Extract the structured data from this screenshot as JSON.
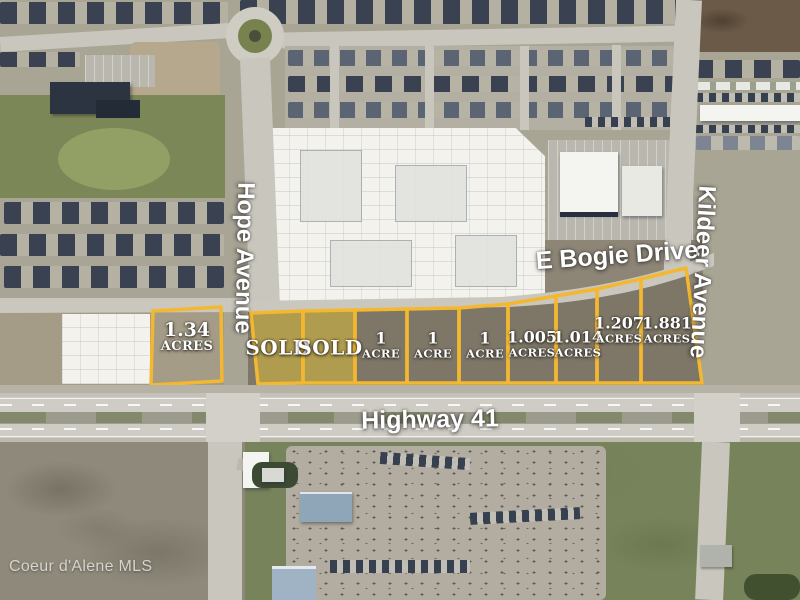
{
  "watermark": "Coeur d'Alene MLS",
  "roads": {
    "hope": "Hope Avenue",
    "bogie": "E Bogie Drive",
    "kildeer": "Kildeer Avenue",
    "highway": "Highway 41"
  },
  "parcels": [
    {
      "line1": "1.34",
      "line2": "ACRES",
      "status": "available"
    },
    {
      "line1": "SOLD",
      "line2": "",
      "status": "sold"
    },
    {
      "line1": "SOLD",
      "line2": "",
      "status": "sold"
    },
    {
      "line1": "1",
      "line2": "ACRE",
      "status": "available"
    },
    {
      "line1": "1",
      "line2": "ACRE",
      "status": "available"
    },
    {
      "line1": "1",
      "line2": "ACRE",
      "status": "available"
    },
    {
      "line1": "1.005",
      "line2": "ACRES",
      "status": "available"
    },
    {
      "line1": "1.014",
      "line2": "ACRES",
      "status": "available"
    },
    {
      "line1": "1.207",
      "line2": "ACRES",
      "status": "available"
    },
    {
      "line1": "1.881",
      "line2": "ACRES",
      "status": "available"
    }
  ],
  "colors": {
    "parcel_outline": "#F3B82F",
    "sold_fill": "#D8BC3A",
    "label_text": "#FFFFFF",
    "watermark_text": "#D6D4CC"
  }
}
